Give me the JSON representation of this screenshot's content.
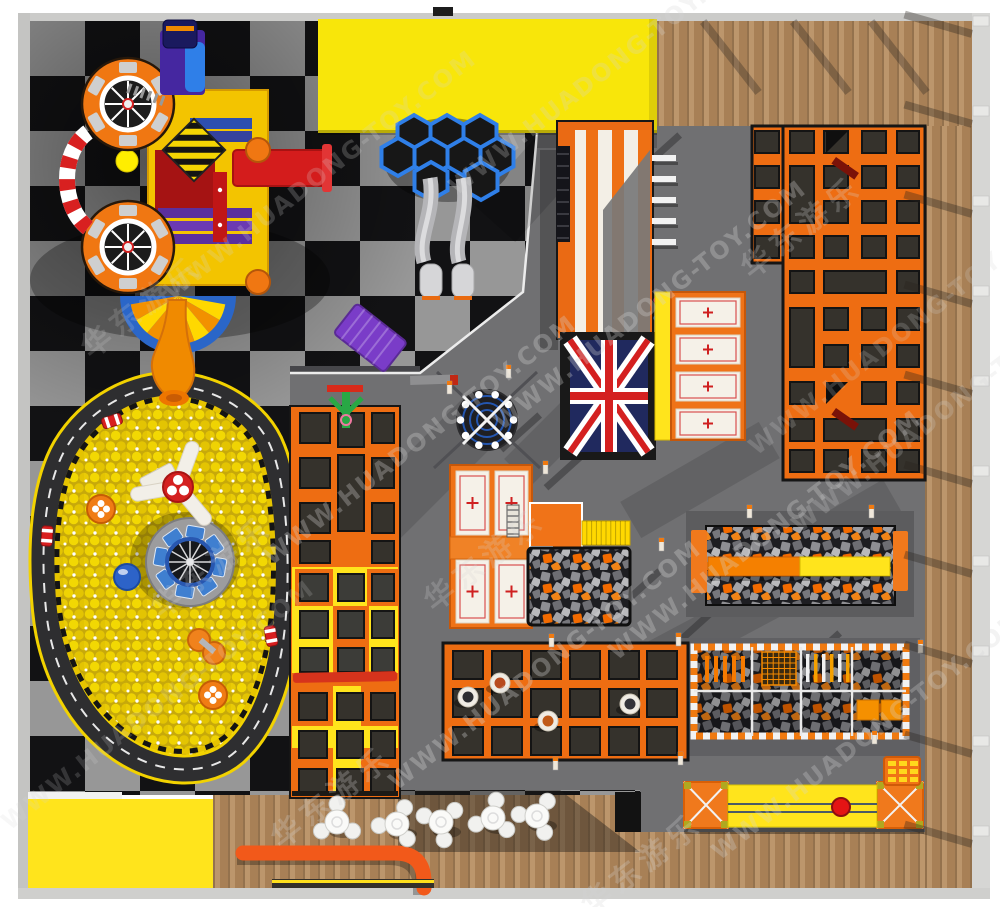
{
  "scene": {
    "name": "indoor-trampoline-park-floor-plan",
    "zones": [
      "soft-play-structure",
      "hexagon-trampolines",
      "slide-tower-union-jack",
      "air-mattress-stack",
      "ball-pit-with-race-track",
      "wall-trampoline-column",
      "main-trampoline-grid",
      "center-air-mattresses",
      "foam-cube-pit",
      "balance-beam-foam-pit",
      "ninja-obstacle-pit",
      "dodgeball-trampoline-court",
      "swing-ball-lane",
      "climbing-block",
      "cafe-seating",
      "reception-mat"
    ]
  },
  "watermark": {
    "en": "WWW.HUADONG-TOY.COM",
    "zh": "华东游乐",
    "tiles": [
      {
        "x": 140,
        "y": 305,
        "t": "zh",
        "o": 0.18
      },
      {
        "x": 320,
        "y": 175,
        "t": "en",
        "o": 0.22
      },
      {
        "x": 605,
        "y": 70,
        "t": "en",
        "o": 0.25
      },
      {
        "x": 210,
        "y": 565,
        "t": "zh",
        "o": 0.2
      },
      {
        "x": 420,
        "y": 440,
        "t": "en",
        "o": 0.3
      },
      {
        "x": 650,
        "y": 305,
        "t": "en",
        "o": 0.3
      },
      {
        "x": 800,
        "y": 225,
        "t": "zh",
        "o": 0.25
      },
      {
        "x": 330,
        "y": 795,
        "t": "zh",
        "o": 0.26
      },
      {
        "x": 545,
        "y": 665,
        "t": "en",
        "o": 0.32
      },
      {
        "x": 765,
        "y": 535,
        "t": "en",
        "o": 0.3
      },
      {
        "x": 948,
        "y": 408,
        "t": "en",
        "o": 0.22
      },
      {
        "x": 640,
        "y": 862,
        "t": "zh",
        "o": 0.26
      },
      {
        "x": 868,
        "y": 735,
        "t": "en",
        "o": 0.28
      },
      {
        "x": 483,
        "y": 558,
        "t": "zh",
        "o": 0.22
      },
      {
        "x": 158,
        "y": 705,
        "t": "en",
        "o": 0.18
      },
      {
        "x": 905,
        "y": 330,
        "t": "en",
        "o": 0.2
      }
    ]
  },
  "palette": {
    "checker-dark": "#121214",
    "checker-gray": "#979797",
    "platform": "#707072",
    "wood": "#b1895e",
    "orange": "#ee6d12",
    "yellow": "#ffe41c",
    "banner": "#f8e60a",
    "bed": "#35322c",
    "panel": "#f5f1e8",
    "red": "#d42020",
    "navy": "#20295e",
    "blue": "#2f7fe8",
    "foam-dark": "#1e1e22",
    "track": "#2e2e30",
    "ball-yellow": "#d9ba00"
  }
}
